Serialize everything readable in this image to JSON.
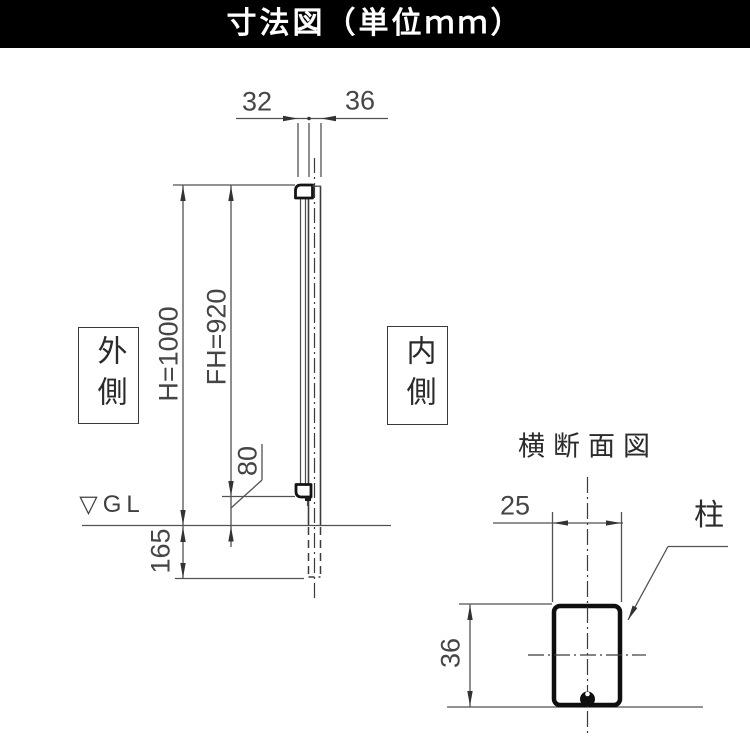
{
  "header": {
    "title": "寸法図（単位ｍｍ）"
  },
  "side_view": {
    "dim_top_left": "32",
    "dim_top_right": "36",
    "dim_height": "H=1000",
    "dim_fence_height": "FH=920",
    "dim_bottom_gap": "80",
    "dim_embed_depth": "165",
    "label_outside": "外側",
    "label_inside": "内側",
    "label_ground_level": "▽GL"
  },
  "cross_section": {
    "title": "横断面図",
    "dim_width": "25",
    "dim_height": "36",
    "label_post": "柱"
  },
  "colors": {
    "header_bg": "#000000",
    "header_text": "#ffffff",
    "thin_line": "#4c4c4c",
    "bold_line": "#141414",
    "dim_text": "#454545"
  }
}
